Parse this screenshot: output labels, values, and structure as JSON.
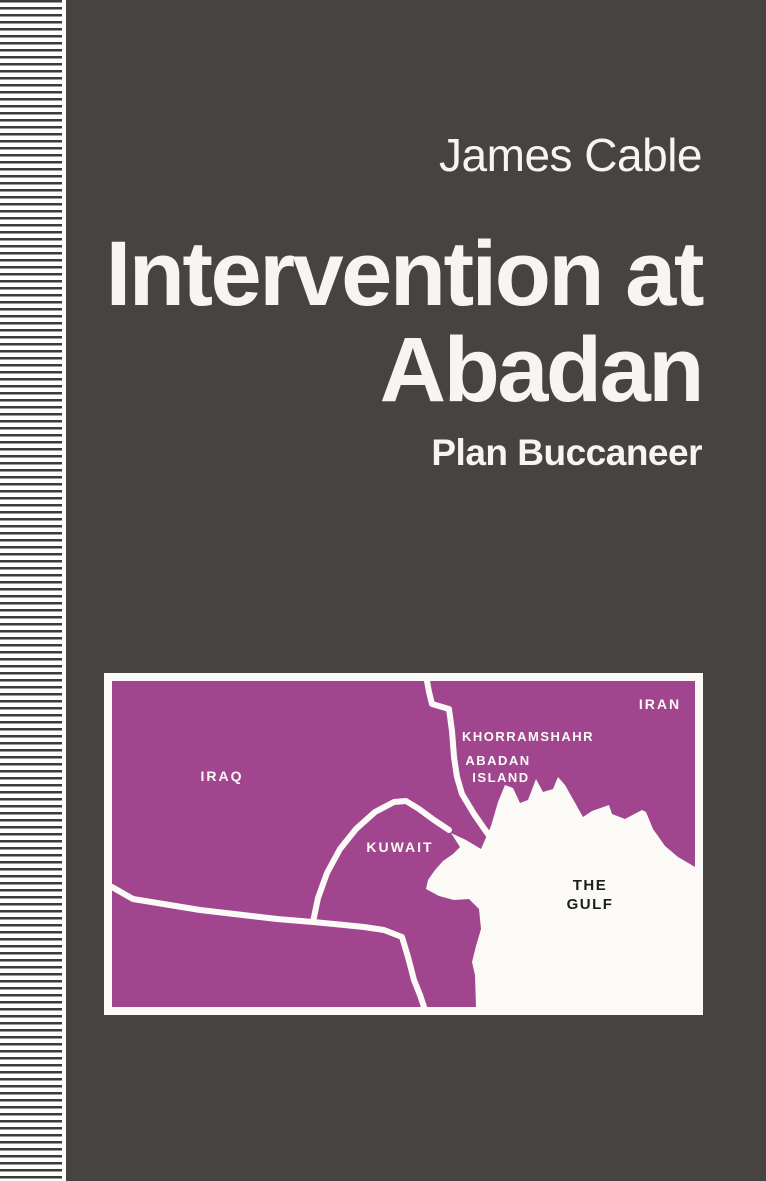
{
  "cover": {
    "author": "James Cable",
    "title_line1": "Intervention at",
    "title_line2": "Abadan",
    "subtitle": "Plan Buccaneer",
    "colors": {
      "background": "#474340",
      "text": "#f7f5f1",
      "stripe_dark": "#3e3a37",
      "stripe_light": "#ffffff",
      "map_purple": "#a1468e",
      "map_white": "#fbfaf7",
      "gulf_label_color": "#1c1c1c"
    }
  },
  "map": {
    "labels": {
      "iran": "IRAN",
      "khorramshahr": "KHORRAMSHAHR",
      "abadan_line1": "ABADAN",
      "abadan_line2": "ISLAND",
      "iraq": "IRAQ",
      "kuwait": "KUWAIT",
      "gulf_line1": "THE",
      "gulf_line2": "GULF"
    }
  }
}
